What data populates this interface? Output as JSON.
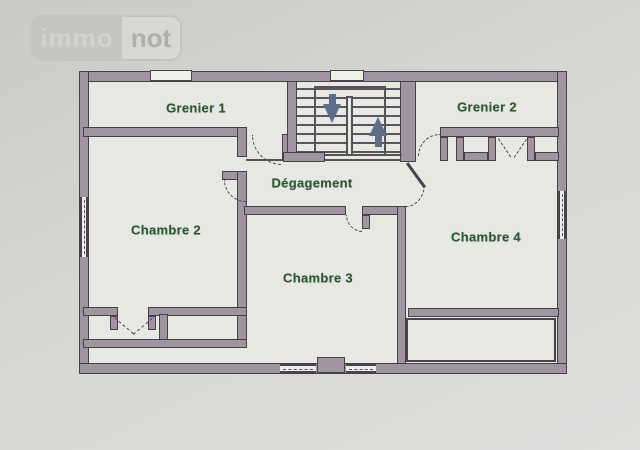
{
  "logo": {
    "immo": "immo",
    "not": "not"
  },
  "rooms": {
    "grenier1": {
      "label": "Grenier 1"
    },
    "grenier2": {
      "label": "Grenier 2"
    },
    "degagement": {
      "label": "Dégagement"
    },
    "chambre2": {
      "label": "Chambre 2"
    },
    "chambre3": {
      "label": "Chambre 3"
    },
    "chambre4": {
      "label": "Chambre 4"
    }
  },
  "stairs": {
    "down_arrow_icon": "stair-direction-down",
    "up_arrow_icon": "stair-direction-up",
    "tread_count": 8
  },
  "colors": {
    "wall_fill": "#9e95a0",
    "wall_outline": "#46404a",
    "label_text": "#2c5634",
    "arrow": "#5d6d8c",
    "paper": "#e7e8e2",
    "background": "#d6d7d2"
  }
}
